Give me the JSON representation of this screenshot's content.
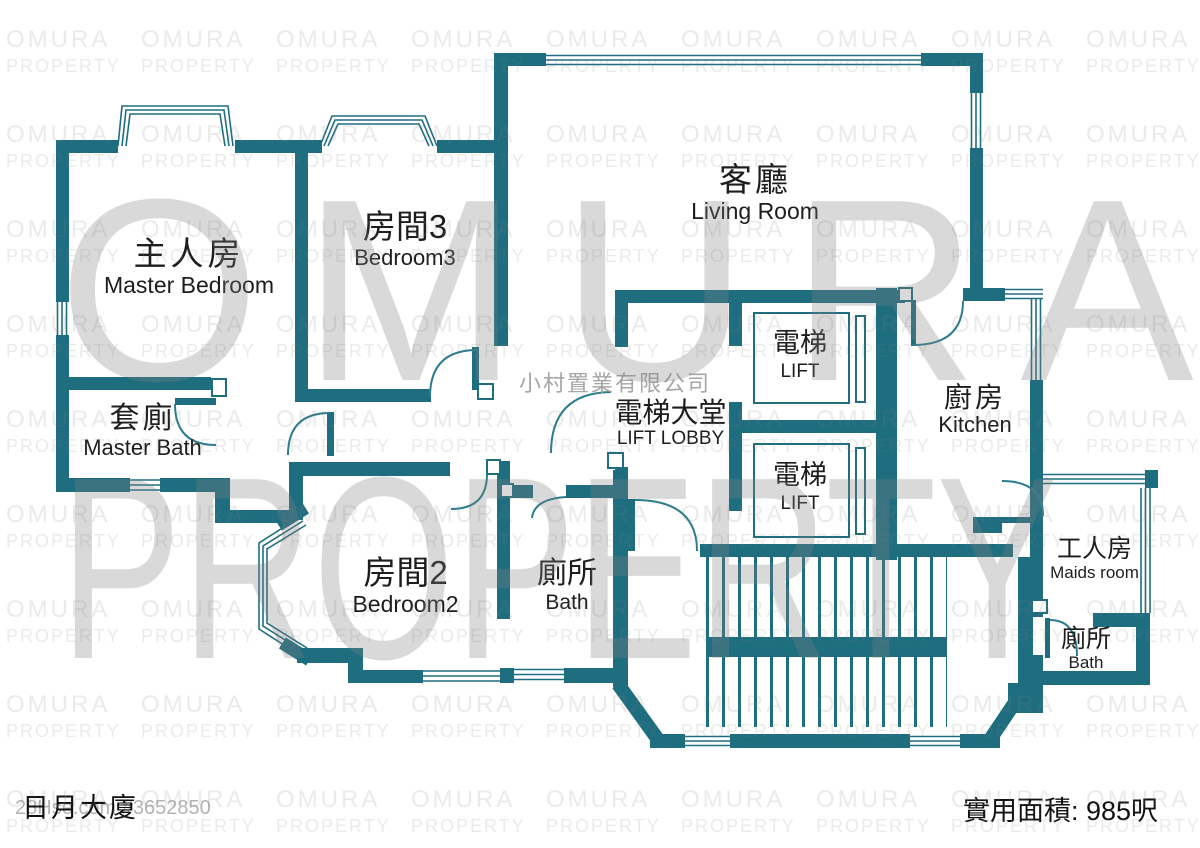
{
  "building": {
    "name": "日月大廈"
  },
  "footer": {
    "listing_ref": "28Hse.com #3652850",
    "area_label": "實用面積: 985呎"
  },
  "watermark": {
    "brand_line1": "OMURA",
    "brand_line2": "PROPERTY",
    "company": "小村置業有限公司"
  },
  "rooms": {
    "master_bedroom": {
      "zh": "主人房",
      "en": "Master Bedroom"
    },
    "bedroom3": {
      "zh": "房間3",
      "en": "Bedroom3"
    },
    "living_room": {
      "zh": "客廳",
      "en": "Living Room"
    },
    "master_bath": {
      "zh": "套廁",
      "en": "Master Bath"
    },
    "lift_lobby": {
      "zh": "電梯大堂",
      "en": "LIFT LOBBY"
    },
    "lift": {
      "zh": "電梯",
      "en": "LIFT"
    },
    "kitchen": {
      "zh": "廚房",
      "en": "Kitchen"
    },
    "bedroom2": {
      "zh": "房間2",
      "en": "Bedroom2"
    },
    "bath": {
      "zh": "廁所",
      "en": "Bath"
    },
    "maids_room": {
      "zh": "工人房",
      "en": "Maids room"
    },
    "maids_bath": {
      "zh": "廁所",
      "en": "Bath"
    }
  },
  "colors": {
    "wall": "#1e6e80",
    "text": "#1d1d1d",
    "watermark": "#9a9a9a"
  }
}
